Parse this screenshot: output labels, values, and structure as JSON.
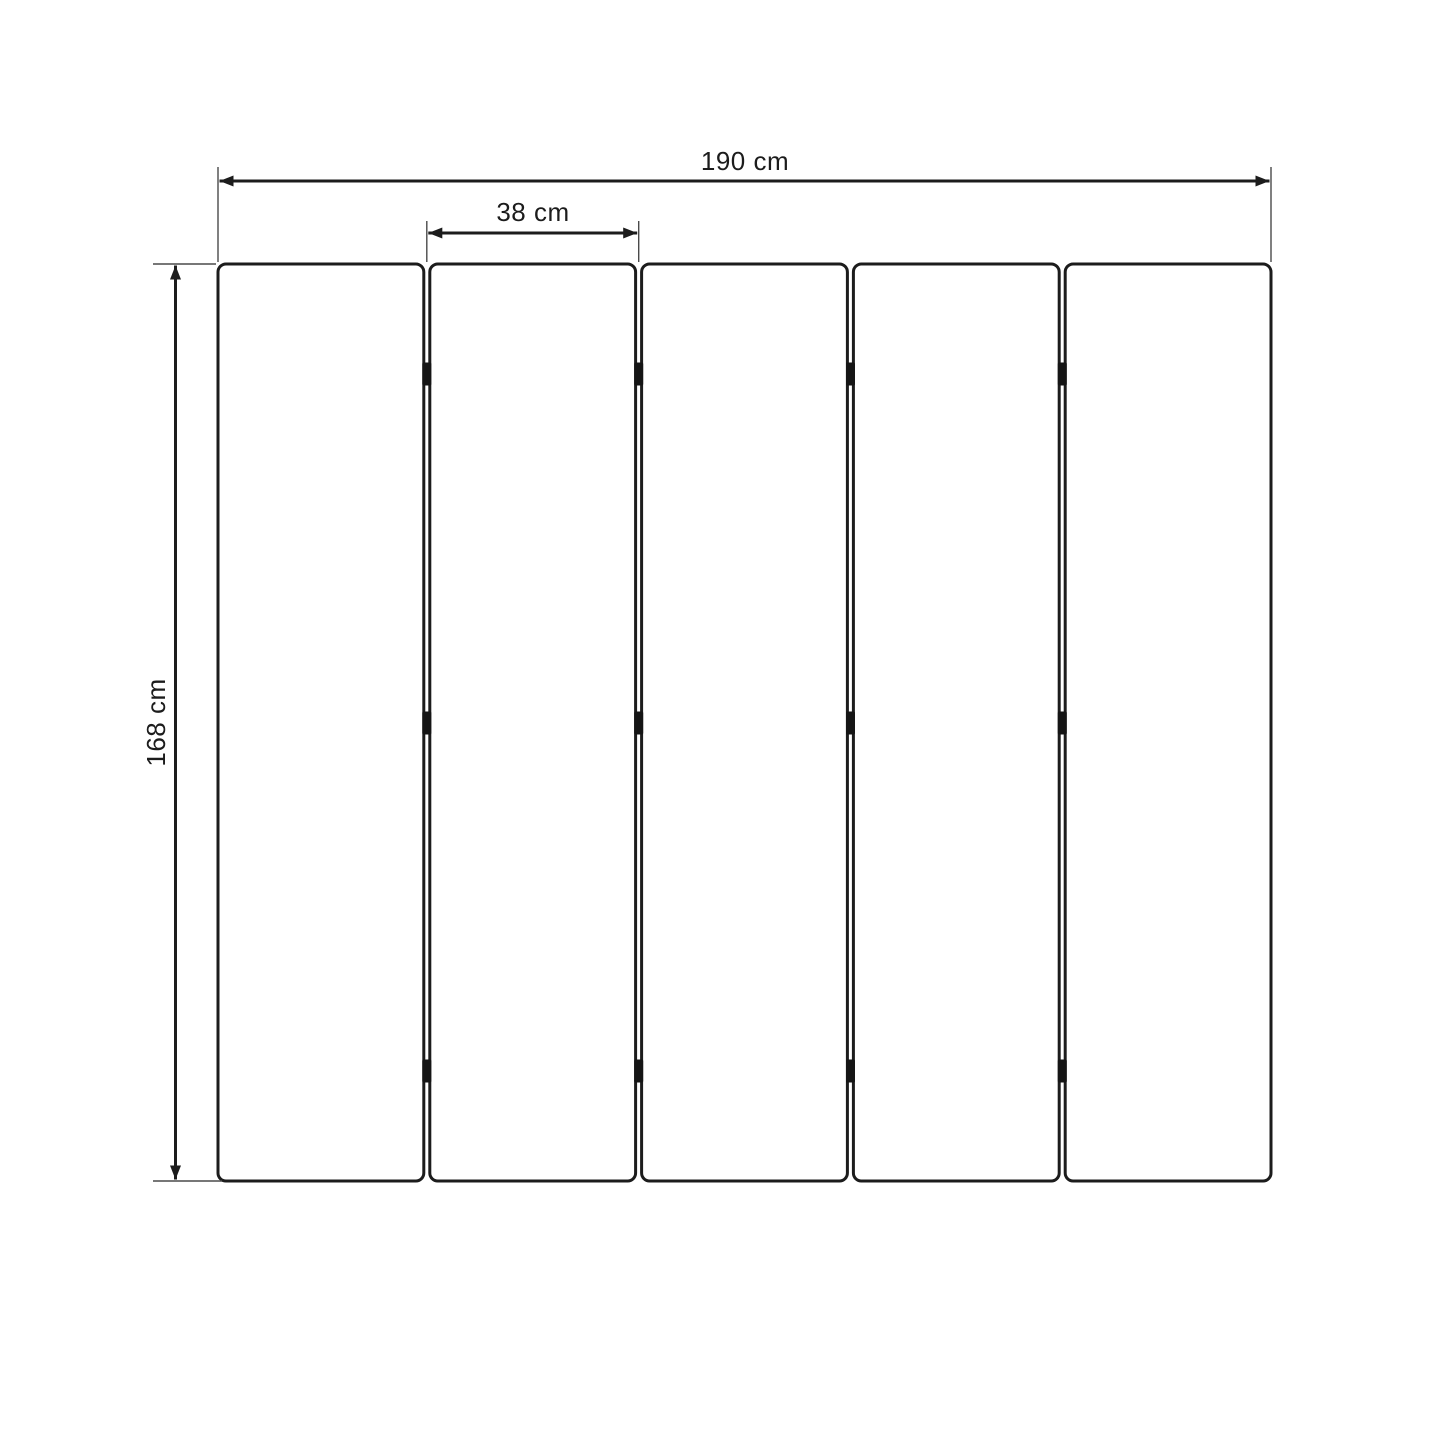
{
  "dimensions": {
    "total_width": {
      "label": "190 cm",
      "value_cm": 190
    },
    "panel_width": {
      "label": "38 cm",
      "value_cm": 38
    },
    "height": {
      "label": "168 cm",
      "value_cm": 168
    }
  },
  "panels": {
    "count": 5,
    "gaps": 4,
    "hinge_rows_per_gap": 3
  },
  "colors": {
    "background": "#ffffff",
    "main_line": "#1c1c1c",
    "extension_line": "#4a4a4a",
    "hinge": "#151515"
  }
}
